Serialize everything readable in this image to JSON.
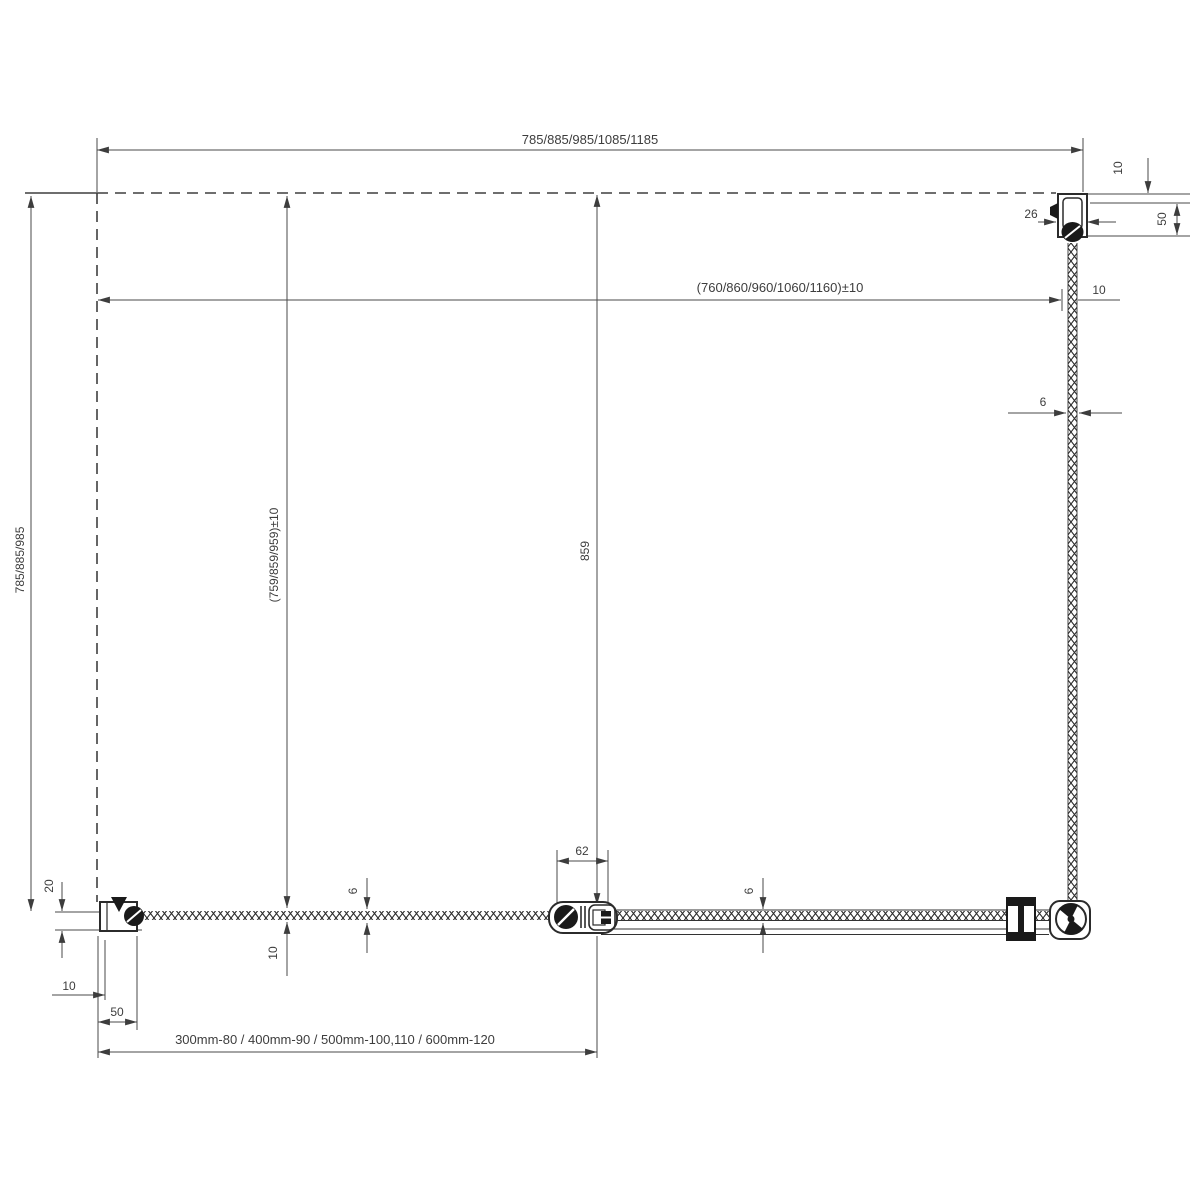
{
  "drawing": {
    "dims": {
      "top_width": "785/885/985/1085/1185",
      "inner_width": "(760/860/960/1060/1160)±10",
      "left_height": "785/885/985",
      "inner_height": "(759/859/959)±10",
      "fixed_panel_length": "859",
      "connector_width": "62",
      "door_glass_thickness": "6",
      "fixed_glass_thickness": "6",
      "side_glass_thickness": "6",
      "wall_profile_width": "26",
      "top_gap": "10",
      "wall_profile_depth": "50",
      "side_gap": "10",
      "hinge_offset": "20",
      "hinge_gap": "10",
      "hinge_width": "50",
      "door_bottom_gap": "10",
      "tray_sizes": "300mm-80 / 400mm-90 / 500mm-100,110 / 600mm-120"
    },
    "colors": {
      "line": "#3d3d3d",
      "profile_fill": "#1a1a1a",
      "background": "#ffffff"
    }
  }
}
